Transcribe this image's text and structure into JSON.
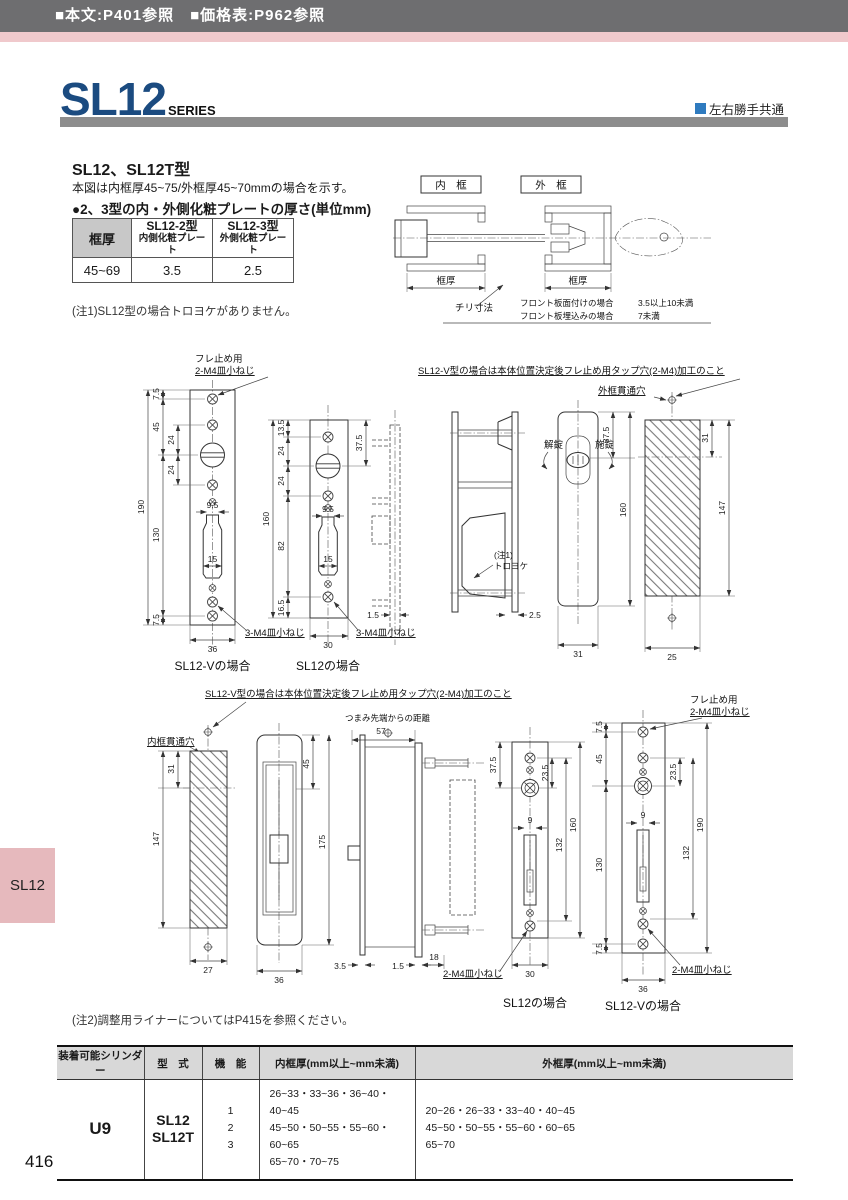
{
  "top_bar": {
    "text": "■本文:P401参照　■価格表:P962参照"
  },
  "header": {
    "title": "SL12",
    "series": "SERIES",
    "handed_label": "左右勝手共通"
  },
  "side_tab": {
    "label": "SL12"
  },
  "footer": {
    "page_number": "416"
  },
  "intro": {
    "model_title": "SL12、SL12T型",
    "model_desc": "本図は内框厚45~75/外框厚45~70mmの場合を示す。",
    "plate_heading": "●2、3型の内・外側化粧プレートの厚さ(単位mm)",
    "note1": "(注1)SL12型の場合トロヨケがありません。",
    "note2": "(注2)調整用ライナーについてはP415を参照ください。"
  },
  "plate_table": {
    "frame_col": "框厚",
    "col2_line1": "SL12-2型",
    "col2_line2": "内側化粧プレート",
    "col3_line1": "SL12-3型",
    "col3_line2": "外側化粧プレート",
    "range": "45~69",
    "inner_val": "3.5",
    "outer_val": "2.5"
  },
  "section_view": {
    "inner_frame_label": "内　框",
    "outer_frame_label": "外　框",
    "frame_dim_left": "框厚",
    "frame_dim_right": "框厚",
    "chiri_label": "チリ寸法",
    "chiri_row1_case": "フロント板面付けの場合",
    "chiri_row1_val": "3.5以上10未満",
    "chiri_row2_case": "フロント板埋込みの場合",
    "chiri_row2_val": "7未満"
  },
  "upper": {
    "fure_label_1": "フレ止め用",
    "fure_label_2": "2-M4皿小ねじ",
    "tap_note": "SL12-V型の場合は本体位置決定後フレ止め用タップ穴(2-M4)加工のこと",
    "outer_hole_label": "外框貫通穴",
    "unlock_label": "解錠",
    "lock_label": "施錠",
    "toroyoke_1": "(注1)",
    "toroyoke_2": "トロヨケ",
    "m4_label_v": "3-M4皿小ねじ",
    "m4_label_s": "3-M4皿小ねじ",
    "caption_v": "SL12-Vの場合",
    "caption_s": "SL12の場合",
    "pv": {
      "d190": "190",
      "d75t": "7.5",
      "d45": "45",
      "d130": "130",
      "d75b": "7.5",
      "d24a": "24",
      "d24b": "24",
      "d95": "9.5",
      "d15": "15",
      "w36": "36"
    },
    "ps": {
      "d160": "160",
      "d135": "13.5",
      "d24a": "24",
      "d24b": "24",
      "d82": "82",
      "d165": "16.5",
      "d375": "37.5",
      "d95": "9.5",
      "d15": "15",
      "w30": "30"
    },
    "sva": {
      "d15": "1.5"
    },
    "svb": {
      "d25": "2.5"
    },
    "tt": {
      "d375": "37.5",
      "d160": "160",
      "w31": "31"
    },
    "hp": {
      "d31": "31",
      "d147": "147",
      "w25": "25"
    }
  },
  "lower": {
    "tap_note": "SL12-V型の場合は本体位置決定後フレ止め用タップ穴(2-M4)加工のこと",
    "inner_hole_label": "内框貫通穴",
    "tip_label": "つまみ先端からの距離",
    "fure_label_1": "フレ止め用",
    "fure_label_2": "2-M4皿小ねじ",
    "m4_label_s": "2-M4皿小ねじ",
    "m4_label_v": "2-M4皿小ねじ",
    "caption_s": "SL12の場合",
    "caption_v": "SL12-Vの場合",
    "hp": {
      "d31": "31",
      "d147": "147",
      "w27": "27"
    },
    "rp": {
      "d45": "45",
      "d175": "175",
      "w36": "36"
    },
    "sv": {
      "d57": "57",
      "d35": "3.5",
      "d15": "1.5",
      "d18": "18"
    },
    "ps": {
      "d375": "37.5",
      "d235": "23.5",
      "d9": "9",
      "d132": "132",
      "d160": "160",
      "w30": "30"
    },
    "pv": {
      "d75t": "7.5",
      "d45": "45",
      "d235": "23.5",
      "d9": "9",
      "d130": "130",
      "d132": "132",
      "d190": "190",
      "d75b": "7.5",
      "w36": "36"
    }
  },
  "spec_table": {
    "headers": [
      "装着可能シリンダー",
      "型　式",
      "機　能",
      "内框厚(mm以上~mm未満)",
      "外框厚(mm以上~mm未満)"
    ],
    "cylinder": "U9",
    "model_1": "SL12",
    "model_2": "SL12T",
    "func_1": "1",
    "func_2": "2",
    "func_3": "3",
    "inner_1": "26~33・33~36・36~40・40~45",
    "inner_2": "45~50・50~55・55~60・60~65",
    "inner_3": "65~70・70~75",
    "outer_1": "20~26・26~33・33~40・40~45",
    "outer_2": "45~50・50~55・55~60・60~65",
    "outer_3": "65~70"
  }
}
